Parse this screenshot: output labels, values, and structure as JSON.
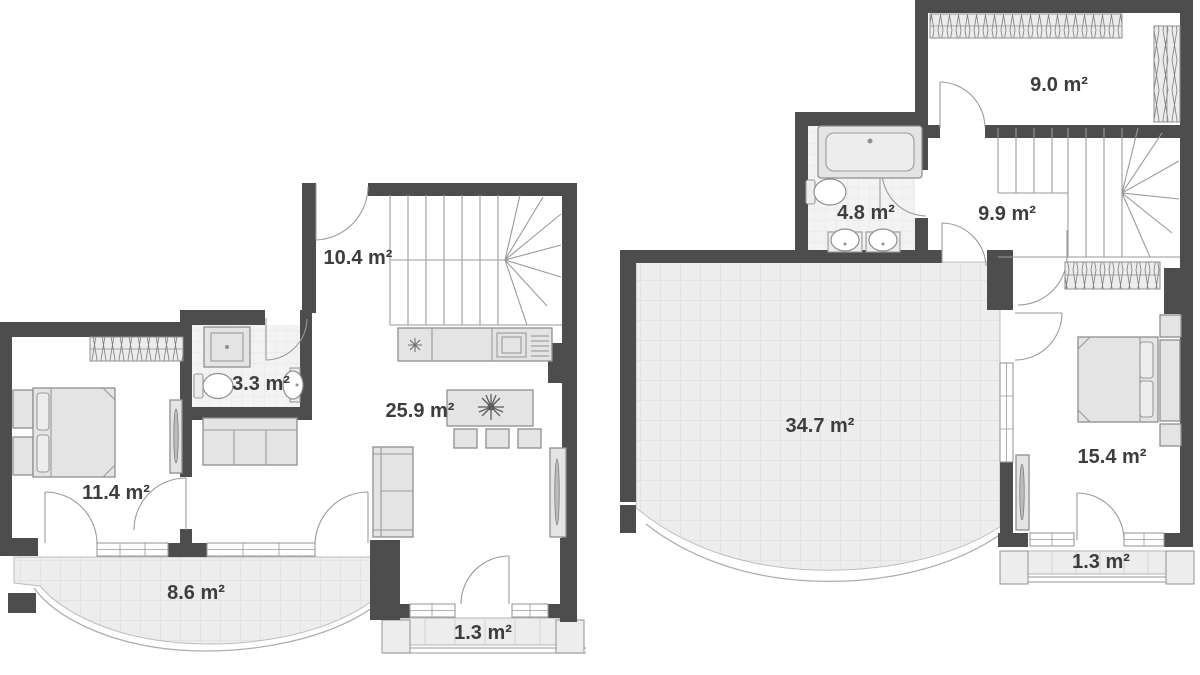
{
  "palette": {
    "wall": "#4d4d4d",
    "outline": "#9a9a9a",
    "furniture_fill": "#e4e4e4",
    "tile_fill": "#ededed",
    "tile_line": "#d9d9d9",
    "label_color": "#3d3d3d",
    "background": "#ffffff"
  },
  "floors": [
    {
      "id": "first-floor",
      "rooms": [
        {
          "id": "hall",
          "area_label": "10.4 m²"
        },
        {
          "id": "bathroom",
          "area_label": "3.3 m²"
        },
        {
          "id": "living-room",
          "area_label": "25.9 m²"
        },
        {
          "id": "bedroom",
          "area_label": "11.4 m²"
        },
        {
          "id": "balcony",
          "area_label": "8.6 m²"
        },
        {
          "id": "loggia",
          "area_label": "1.3 m²"
        }
      ],
      "icons": [
        "staircase-icon",
        "kitchen-counter-icon",
        "hob-icon",
        "kitchen-sink-icon",
        "appliance-icon",
        "dining-table-icon",
        "plant-icon",
        "chair-icon",
        "sofa-icon",
        "tv-icon",
        "bed-icon",
        "nightstand-icon",
        "wardrobe-icon",
        "shower-icon",
        "toilet-icon",
        "washbasin-icon",
        "door-icon",
        "window-icon",
        "pillar-icon"
      ]
    },
    {
      "id": "second-floor",
      "rooms": [
        {
          "id": "room",
          "area_label": "9.0 m²"
        },
        {
          "id": "bathroom",
          "area_label": "4.8 m²"
        },
        {
          "id": "hall",
          "area_label": "9.9 m²"
        },
        {
          "id": "terrace",
          "area_label": "34.7 m²"
        },
        {
          "id": "bedroom",
          "area_label": "15.4 m²"
        },
        {
          "id": "balcony",
          "area_label": "1.3 m²"
        }
      ],
      "icons": [
        "staircase-icon",
        "bathtub-icon",
        "toilet-icon",
        "washbasin-icon",
        "wardrobe-icon",
        "bed-icon",
        "nightstand-icon",
        "tv-icon",
        "door-icon",
        "window-icon",
        "pillar-icon"
      ]
    }
  ]
}
